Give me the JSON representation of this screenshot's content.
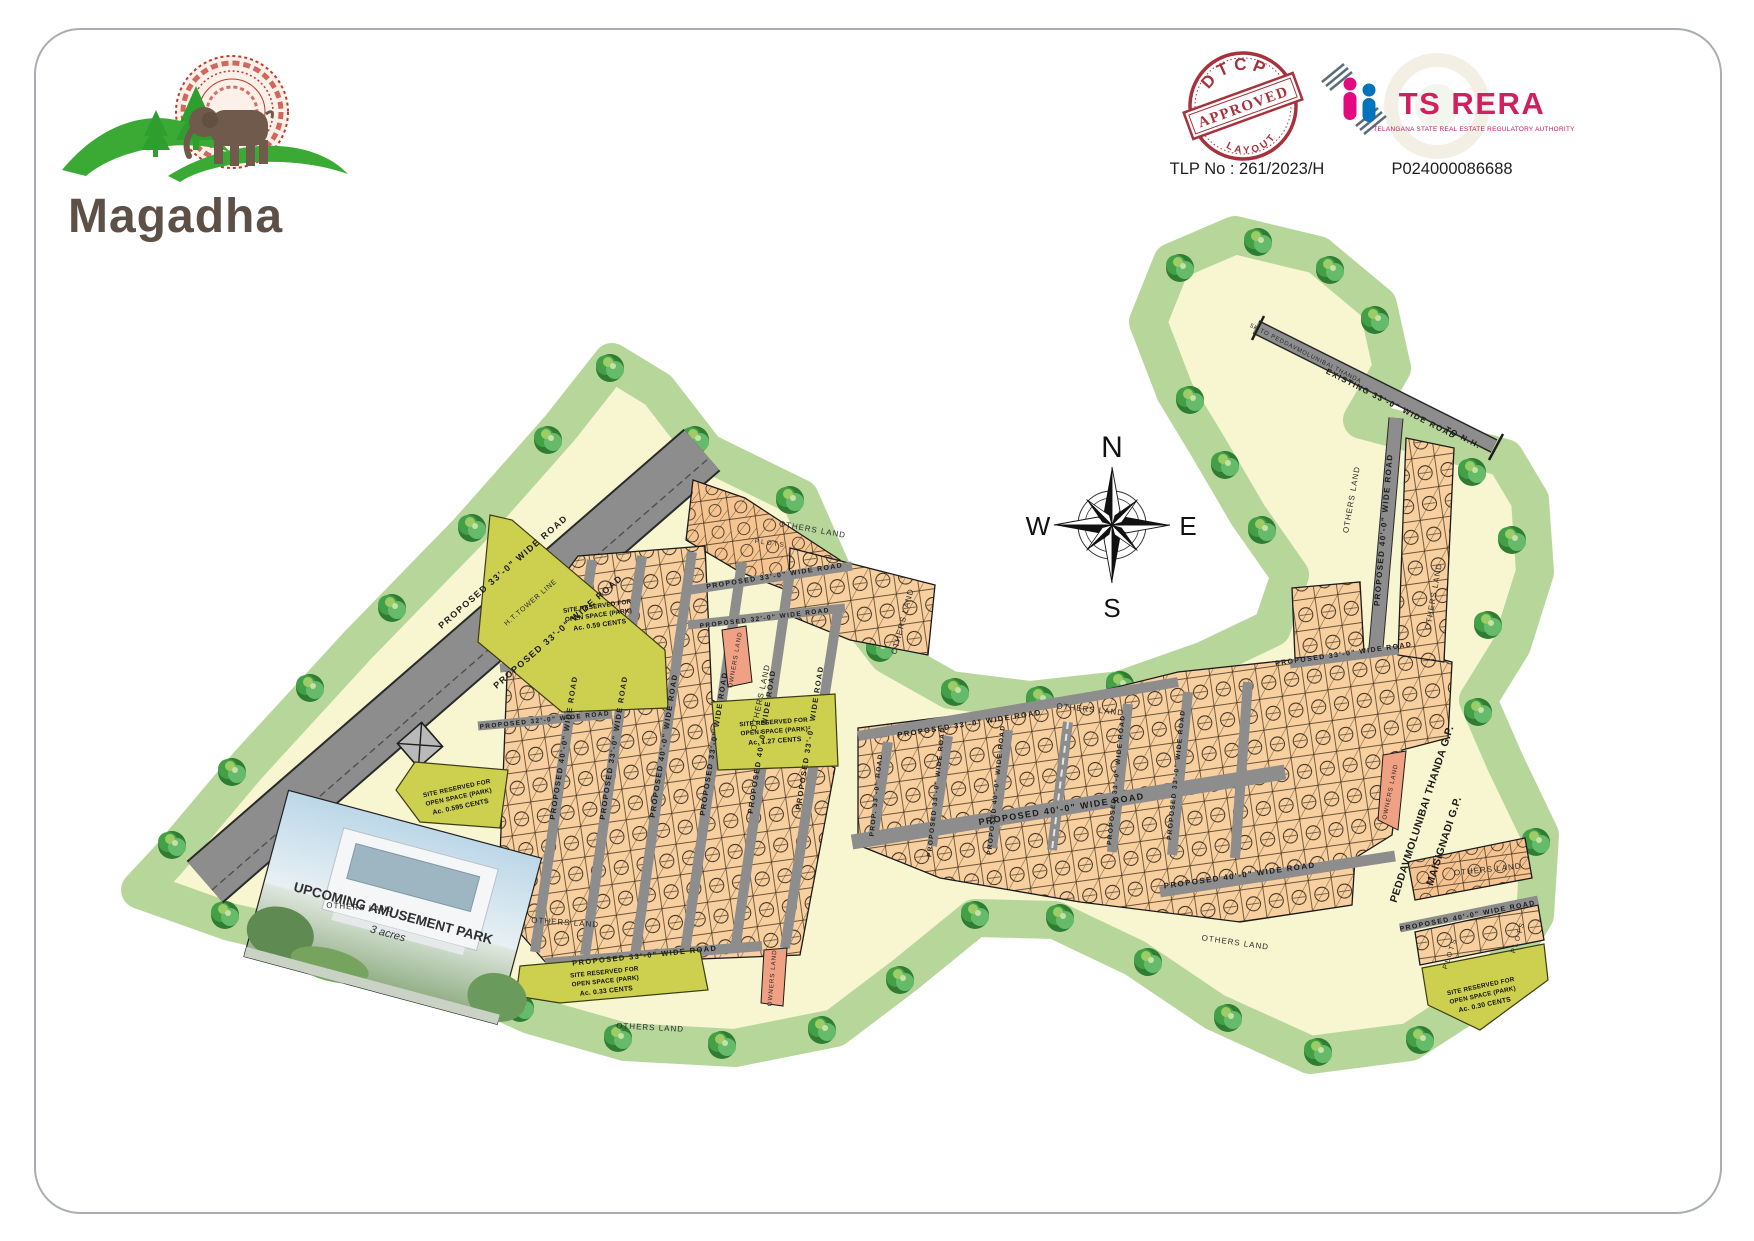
{
  "brand": {
    "name": "Magadha"
  },
  "approvals": {
    "dtcp_stamp": {
      "top": "DTCP",
      "middle": "APPROVED",
      "bottom": "LAYOUT"
    },
    "tlp_no": "TLP No : 261/2023/H",
    "rera_name": "TS RERA",
    "rera_subtitle": "TELANGANA STATE REAL ESTATE REGULATORY AUTHORITY",
    "rera_reg_no": "P024000086688"
  },
  "compass": {
    "n": "N",
    "e": "E",
    "s": "S",
    "w": "W"
  },
  "map": {
    "roads": {
      "proposed_33": "PROPOSED 33'-0\" WIDE ROAD",
      "proposed_40": "PROPOSED 40'-0\" WIDE ROAD",
      "proposed_32": "PROPOSED 32'-0\" WIDE ROAD",
      "prop_33_short": "PROP. 33'-0\" ROAD",
      "existing_33": "EXISTING 33'-0\" WIDE ROAD",
      "ht_tower_line": "H.T.TOWER LINE",
      "to_nh": "TO N.H.",
      "to_thanda": "5K TO PEDDAVMOLUNIBAI THANDA"
    },
    "labels": {
      "others_land": "OTHERS LAND",
      "owners_land": "OWNERS LAND",
      "plots": "PLOTS",
      "gp_line1": "PEDDAVMOLUNIBAI THANDA G.P.",
      "gp_line2": "MAISIGNADI G.P."
    },
    "open_space": {
      "line1": "SITE RESERVED FOR",
      "line2": "OPEN SPACE (PARK)",
      "park1_area": "Ac. 0.59 CENTS",
      "park2_area": "Ac. 0.595 CENTS",
      "park3_area": "Ac. 1.27 CENTS",
      "park4_area": "Ac. 0.33 CENTS",
      "park5_area": "Ac. 0.30 CENTS"
    },
    "amusement_park": {
      "title": "UPCOMING AMUSEMENT PARK",
      "subtitle": "3 acres"
    }
  },
  "colors": {
    "land_cream": "#f8f6d0",
    "green_band": "#b7d79a",
    "plot_orange": "#f8cf9e",
    "road_gray": "#8d8d8d",
    "park_olive": "#cdd04f",
    "owners_salmon": "#f0a183",
    "stamp_red": "#a8323c",
    "rera_pink": "#d11f5f"
  }
}
